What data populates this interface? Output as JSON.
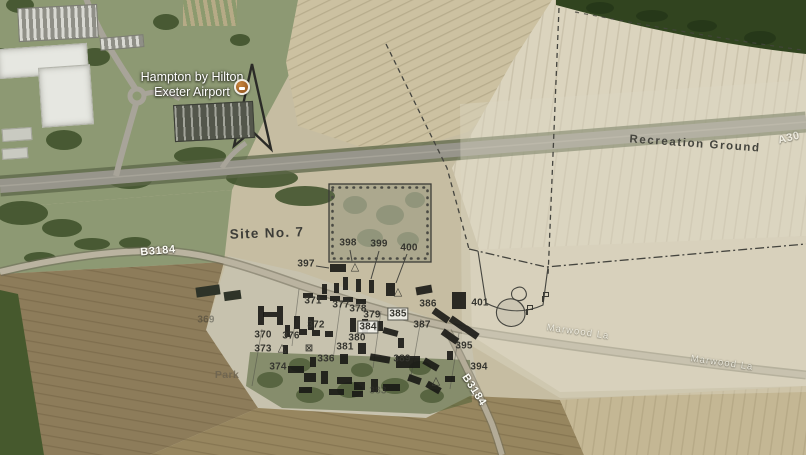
{
  "scene": {
    "description_labels": {
      "hotel_line1": "Hampton by Hilton",
      "hotel_line2": "Exeter Airport"
    },
    "colors": {
      "field_tan": "#c6bda2",
      "field_pale": "#dbd4be",
      "field_brown": "#8d7c5a",
      "woodland_green": "#31441f",
      "grass_green": "#8d9973",
      "road_gray": "#97958b",
      "overlay_ink": "#45453f",
      "building_black": "#181815",
      "marker_orange": "#8a4d1c",
      "road_label_white": "#fdfdf6",
      "map_label_dark": "#3d3d38"
    },
    "map_labels": [
      {
        "text": "Recreation Ground",
        "x": 695,
        "y": 144,
        "rot": 4,
        "cls": "ls2",
        "name": "recreation-ground-label"
      },
      {
        "text": "Site No. 7",
        "x": 267,
        "y": 233,
        "rot": -2,
        "cls": "lg",
        "name": "site-no-7-label"
      },
      {
        "text": "Park",
        "x": 227,
        "y": 375,
        "rot": 0,
        "cls": "faintdark",
        "name": "park-label"
      }
    ],
    "road_labels": [
      {
        "text": "B3184",
        "x": 158,
        "y": 251,
        "rot": -5,
        "cls": "",
        "name": "b3184-label-west"
      },
      {
        "text": "A30",
        "x": 789,
        "y": 138,
        "rot": -14,
        "cls": "dim",
        "name": "a30-label"
      },
      {
        "text": "Marwood La",
        "x": 578,
        "y": 332,
        "rot": 8,
        "cls": "dim sm",
        "name": "marwood-lane-label-1"
      },
      {
        "text": "Marwood La",
        "x": 722,
        "y": 363,
        "rot": 8,
        "cls": "dim sm",
        "name": "marwood-lane-label-2"
      },
      {
        "text": "B3184",
        "x": 474,
        "y": 390,
        "rot": 57,
        "cls": "",
        "name": "b3184-label-south"
      }
    ],
    "building_numbers": [
      {
        "n": "369",
        "x": 206,
        "y": 320,
        "f": true
      },
      {
        "n": "370",
        "x": 263,
        "y": 335
      },
      {
        "n": "371",
        "x": 313,
        "y": 301
      },
      {
        "n": "372",
        "x": 316,
        "y": 325
      },
      {
        "n": "373",
        "x": 263,
        "y": 349
      },
      {
        "n": "374",
        "x": 278,
        "y": 367
      },
      {
        "n": "376",
        "x": 291,
        "y": 336
      },
      {
        "n": "377",
        "x": 341,
        "y": 305
      },
      {
        "n": "378",
        "x": 358,
        "y": 309
      },
      {
        "n": "379",
        "x": 372,
        "y": 315
      },
      {
        "n": "380",
        "x": 357,
        "y": 338
      },
      {
        "n": "381",
        "x": 345,
        "y": 347
      },
      {
        "n": "383",
        "x": 378,
        "y": 391,
        "f": true
      },
      {
        "n": "384",
        "x": 368,
        "y": 327,
        "box": true
      },
      {
        "n": "385",
        "x": 398,
        "y": 314,
        "box": true
      },
      {
        "n": "386",
        "x": 428,
        "y": 304
      },
      {
        "n": "387",
        "x": 422,
        "y": 325
      },
      {
        "n": "389",
        "x": 402,
        "y": 359
      },
      {
        "n": "336",
        "x": 326,
        "y": 359
      },
      {
        "n": "394",
        "x": 479,
        "y": 367
      },
      {
        "n": "395",
        "x": 464,
        "y": 346
      },
      {
        "n": "397",
        "x": 306,
        "y": 264
      },
      {
        "n": "398",
        "x": 348,
        "y": 243
      },
      {
        "n": "399",
        "x": 379,
        "y": 244
      },
      {
        "n": "400",
        "x": 409,
        "y": 248
      },
      {
        "n": "401",
        "x": 480,
        "y": 303
      }
    ],
    "plan_buildings": [
      {
        "x": 330,
        "y": 264,
        "w": 16,
        "h": 8,
        "r": 0
      },
      {
        "x": 343,
        "y": 277,
        "w": 5,
        "h": 13,
        "r": 0
      },
      {
        "x": 356,
        "y": 279,
        "w": 5,
        "h": 13,
        "r": 0
      },
      {
        "x": 369,
        "y": 280,
        "w": 5,
        "h": 13,
        "r": 0
      },
      {
        "x": 386,
        "y": 283,
        "w": 9,
        "h": 13,
        "r": 0
      },
      {
        "x": 322,
        "y": 284,
        "w": 5,
        "h": 10,
        "r": 0
      },
      {
        "x": 334,
        "y": 283,
        "w": 5,
        "h": 10,
        "r": 0
      },
      {
        "x": 303,
        "y": 293,
        "w": 10,
        "h": 5,
        "r": 0
      },
      {
        "x": 317,
        "y": 295,
        "w": 10,
        "h": 5,
        "r": 0
      },
      {
        "x": 330,
        "y": 296,
        "w": 10,
        "h": 5,
        "r": 0
      },
      {
        "x": 343,
        "y": 297,
        "w": 10,
        "h": 5,
        "r": 0
      },
      {
        "x": 356,
        "y": 299,
        "w": 10,
        "h": 5,
        "r": 0
      },
      {
        "x": 452,
        "y": 292,
        "w": 14,
        "h": 17,
        "r": 0
      },
      {
        "x": 416,
        "y": 286,
        "w": 16,
        "h": 8,
        "r": -10
      },
      {
        "x": 258,
        "y": 306,
        "w": 6,
        "h": 19,
        "r": 0
      },
      {
        "x": 277,
        "y": 306,
        "w": 6,
        "h": 19,
        "r": 0
      },
      {
        "x": 263,
        "y": 312,
        "w": 14,
        "h": 5,
        "r": 0
      },
      {
        "x": 294,
        "y": 316,
        "w": 6,
        "h": 13,
        "r": 0
      },
      {
        "x": 308,
        "y": 317,
        "w": 6,
        "h": 13,
        "r": 0
      },
      {
        "x": 285,
        "y": 325,
        "w": 5,
        "h": 12,
        "r": 0
      },
      {
        "x": 350,
        "y": 318,
        "w": 6,
        "h": 14,
        "r": 0
      },
      {
        "x": 362,
        "y": 319,
        "w": 6,
        "h": 14,
        "r": 0
      },
      {
        "x": 374,
        "y": 321,
        "w": 9,
        "h": 10,
        "r": 0
      },
      {
        "x": 299,
        "y": 329,
        "w": 8,
        "h": 6,
        "r": 0
      },
      {
        "x": 312,
        "y": 330,
        "w": 8,
        "h": 6,
        "r": 0
      },
      {
        "x": 325,
        "y": 331,
        "w": 8,
        "h": 6,
        "r": 0
      },
      {
        "x": 383,
        "y": 329,
        "w": 15,
        "h": 6,
        "r": 15
      },
      {
        "x": 432,
        "y": 312,
        "w": 18,
        "h": 7,
        "r": 35
      },
      {
        "x": 449,
        "y": 320,
        "w": 18,
        "h": 7,
        "r": 35
      },
      {
        "x": 441,
        "y": 333,
        "w": 18,
        "h": 7,
        "r": 35
      },
      {
        "x": 464,
        "y": 329,
        "w": 15,
        "h": 7,
        "r": 35
      },
      {
        "x": 398,
        "y": 338,
        "w": 6,
        "h": 10,
        "r": 0
      },
      {
        "x": 358,
        "y": 343,
        "w": 8,
        "h": 11,
        "r": 0
      },
      {
        "x": 340,
        "y": 354,
        "w": 8,
        "h": 10,
        "r": 0
      },
      {
        "x": 310,
        "y": 357,
        "w": 6,
        "h": 10,
        "r": 0
      },
      {
        "x": 370,
        "y": 355,
        "w": 20,
        "h": 7,
        "r": 10
      },
      {
        "x": 396,
        "y": 356,
        "w": 24,
        "h": 12,
        "r": 0
      },
      {
        "x": 423,
        "y": 361,
        "w": 16,
        "h": 7,
        "r": 30
      },
      {
        "x": 288,
        "y": 366,
        "w": 16,
        "h": 7,
        "r": 0
      },
      {
        "x": 304,
        "y": 373,
        "w": 12,
        "h": 9,
        "r": 0
      },
      {
        "x": 321,
        "y": 371,
        "w": 7,
        "h": 13,
        "r": 0
      },
      {
        "x": 337,
        "y": 377,
        "w": 15,
        "h": 7,
        "r": 0
      },
      {
        "x": 354,
        "y": 382,
        "w": 11,
        "h": 8,
        "r": 0
      },
      {
        "x": 371,
        "y": 379,
        "w": 7,
        "h": 13,
        "r": 0
      },
      {
        "x": 299,
        "y": 387,
        "w": 13,
        "h": 6,
        "r": 0
      },
      {
        "x": 329,
        "y": 389,
        "w": 15,
        "h": 6,
        "r": 0
      },
      {
        "x": 352,
        "y": 391,
        "w": 11,
        "h": 6,
        "r": 0
      },
      {
        "x": 383,
        "y": 384,
        "w": 17,
        "h": 7,
        "r": 0
      },
      {
        "x": 408,
        "y": 376,
        "w": 13,
        "h": 7,
        "r": 20
      },
      {
        "x": 426,
        "y": 384,
        "w": 15,
        "h": 7,
        "r": 30
      },
      {
        "x": 445,
        "y": 376,
        "w": 10,
        "h": 6,
        "r": 0
      },
      {
        "x": 447,
        "y": 351,
        "w": 6,
        "h": 9,
        "r": 0
      },
      {
        "x": 283,
        "y": 345,
        "w": 5,
        "h": 9,
        "r": 0
      }
    ],
    "aerial_buildings": [
      {
        "x": -2,
        "y": 46,
        "w": 90,
        "h": 30,
        "r": -4,
        "cls": "a-light"
      },
      {
        "x": 40,
        "y": 66,
        "w": 52,
        "h": 60,
        "r": -4,
        "cls": "a-light"
      },
      {
        "x": 2,
        "y": 128,
        "w": 30,
        "h": 13,
        "r": -4,
        "cls": "a-mid"
      },
      {
        "x": 2,
        "y": 148,
        "w": 26,
        "h": 11,
        "r": -4,
        "cls": "a-mid"
      },
      {
        "x": 18,
        "y": 6,
        "w": 80,
        "h": 34,
        "r": -3,
        "cls": "a-lot"
      },
      {
        "x": 100,
        "y": 36,
        "w": 44,
        "h": 13,
        "r": -5,
        "cls": "a-lot"
      },
      {
        "x": 183,
        "y": 0,
        "w": 54,
        "h": 26,
        "r": 0,
        "cls": "a-stripe"
      },
      {
        "x": 174,
        "y": 103,
        "w": 80,
        "h": 37,
        "r": -3,
        "cls": "a-hotel"
      },
      {
        "x": 196,
        "y": 286,
        "w": 24,
        "h": 10,
        "r": -8,
        "cls": "a-dark"
      },
      {
        "x": 224,
        "y": 291,
        "w": 17,
        "h": 9,
        "r": -8,
        "cls": "a-dark"
      }
    ],
    "symbols": [
      {
        "t": "tri",
        "x": 355,
        "y": 267
      },
      {
        "t": "tri",
        "x": 398,
        "y": 292
      },
      {
        "t": "tri",
        "x": 282,
        "y": 348
      },
      {
        "t": "tri",
        "x": 436,
        "y": 381
      },
      {
        "t": "boxx",
        "x": 309,
        "y": 349
      },
      {
        "t": "flag",
        "x": 543,
        "y": 292
      },
      {
        "t": "flag",
        "x": 527,
        "y": 305
      }
    ]
  }
}
